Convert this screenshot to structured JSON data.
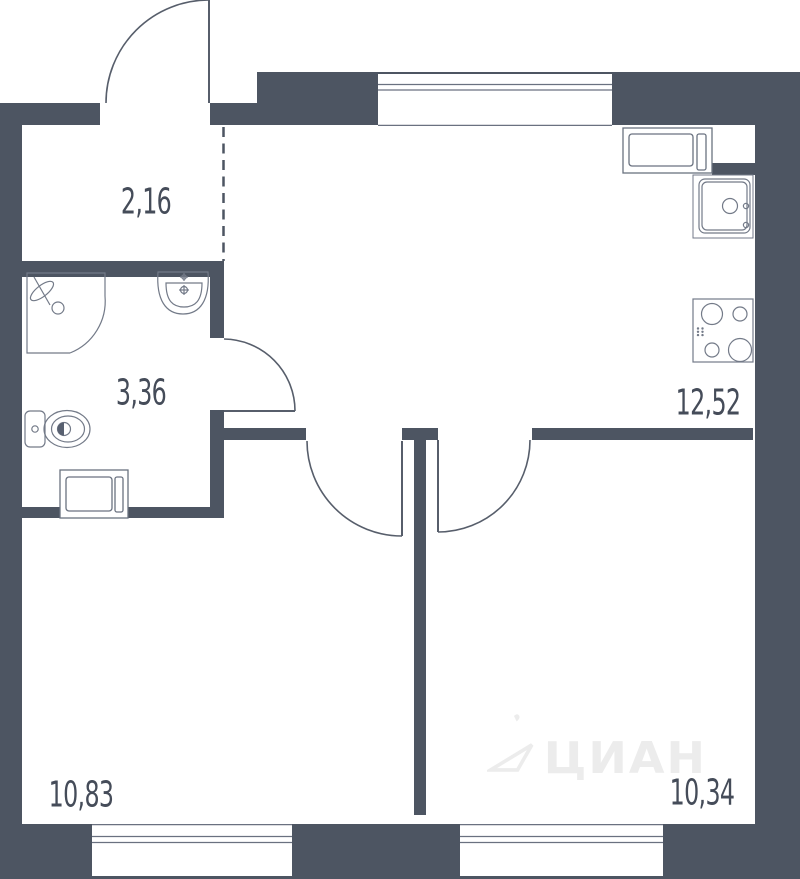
{
  "floor_plan": {
    "rooms": [
      {
        "id": "hallway",
        "area_label": "2,16"
      },
      {
        "id": "bathroom",
        "area_label": "3,36"
      },
      {
        "id": "kitchen-living",
        "area_label": "12,52"
      },
      {
        "id": "room-left",
        "area_label": "10,83"
      },
      {
        "id": "room-right",
        "area_label": "10,34"
      }
    ],
    "watermark": {
      "text": "ЦИАН"
    },
    "colors": {
      "wall": "#4d5562",
      "fixture_line": "#737a88",
      "door_line": "#575e6b",
      "label_text": "#454c59",
      "watermark": "#ececec",
      "background": "#ffffff"
    }
  }
}
